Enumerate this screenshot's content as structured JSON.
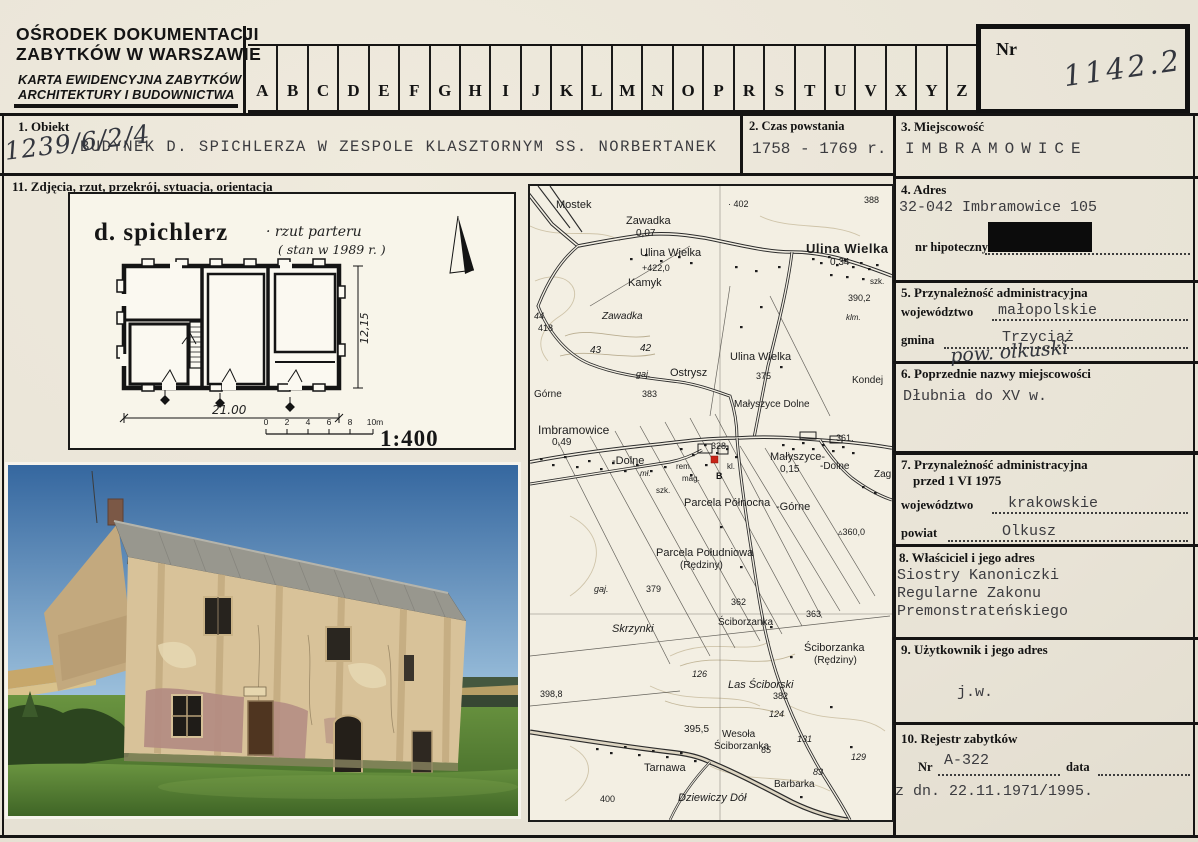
{
  "header": {
    "org_line1": "OŚRODEK DOKUMENTACJI",
    "org_line2": "ZABYTKÓW W WARSZAWIE",
    "card_type_line1": "KARTA EWIDENCYJNA ZABYTKÓW",
    "card_type_line2": "ARCHITEKTURY I BUDOWNICTWA",
    "alphabet": [
      "A",
      "B",
      "C",
      "D",
      "E",
      "F",
      "G",
      "H",
      "I",
      "J",
      "K",
      "L",
      "M",
      "N",
      "O",
      "P",
      "R",
      "S",
      "T",
      "U",
      "V",
      "X",
      "Y",
      "Z"
    ],
    "nr_label": "Nr",
    "nr_value": "1142.2"
  },
  "fields": {
    "obiekt": {
      "label": "1. Obiekt",
      "value": "BUDYNEK D. SPICHLERZA W ZESPOLE KLASZTORNYM SS. NORBERTANEK",
      "annotation": "1239/6/2/4"
    },
    "czas": {
      "label": "2. Czas powstania",
      "value": "1758 - 1769 r."
    },
    "miejscowosc": {
      "label": "3. Miejscowość",
      "value": "IMBRAMOWICE"
    },
    "adres": {
      "label": "4. Adres",
      "value": "32-042 Imbramowice 105",
      "hipoteczny_label": "nr hipoteczny"
    },
    "admin": {
      "label": "5. Przynależność administracyjna",
      "wojewodztwo_label": "województwo",
      "wojewodztwo": "małopolskie",
      "gmina_label": "gmina",
      "gmina": "Trzyciąż",
      "annotation": "pow. olkuski"
    },
    "poprzednie": {
      "label": "6. Poprzednie nazwy miejscowości",
      "value": "Dłubnia do XV w."
    },
    "admin1975": {
      "label_line1": "7. Przynależność administracyjna",
      "label_line2": "przed 1 VI 1975",
      "wojewodztwo_label": "województwo",
      "wojewodztwo": "krakowskie",
      "powiat_label": "powiat",
      "powiat": "Olkusz"
    },
    "wlasciciel": {
      "label": "8. Właściciel i jego adres",
      "line1": "Siostry Kanoniczki",
      "line2": "Regularne Zakonu",
      "line3": "Premonstrateńskiego"
    },
    "uzytkownik": {
      "label": "9. Użytkownik i jego adres",
      "value": "j.w."
    },
    "rejestr": {
      "label": "10. Rejestr zabytków",
      "nr_label": "Nr",
      "nr_value": "A-322",
      "data_label": "data",
      "data_value": "z dn. 22.11.1971/1995."
    },
    "zdjecia": {
      "label": "11. Zdjęcia, rzut, przekrój, sytuacja, orientacja"
    }
  },
  "drawing": {
    "title": "d. spichlerz",
    "subtitle1": "· rzut parteru",
    "subtitle2": "( stan w 1989 r. )",
    "dim_width": "21.00",
    "dim_height": "12,15",
    "scale": "1:400",
    "scale_ticks": [
      "0",
      "2",
      "4",
      "6",
      "8",
      "10m"
    ]
  },
  "map": {
    "marker": "B",
    "labels": [
      {
        "t": "Mostek",
        "x": 26,
        "y": 14,
        "s": 11
      },
      {
        "t": "Zawadka",
        "x": 96,
        "y": 30,
        "s": 11
      },
      {
        "t": "0,07",
        "x": 106,
        "y": 43,
        "s": 10
      },
      {
        "t": "· 402",
        "x": 198,
        "y": 14,
        "s": 9
      },
      {
        "t": "388",
        "x": 334,
        "y": 10,
        "s": 9
      },
      {
        "t": "Ulina Wielka",
        "x": 110,
        "y": 62,
        "s": 11
      },
      {
        "t": "+422,0",
        "x": 112,
        "y": 78,
        "s": 9
      },
      {
        "t": "Kamyk",
        "x": 98,
        "y": 92,
        "s": 11
      },
      {
        "t": "Ulina Wielka",
        "x": 276,
        "y": 56,
        "s": 13,
        "b": 1
      },
      {
        "t": "0,34",
        "x": 300,
        "y": 72,
        "s": 10
      },
      {
        "t": "szk.",
        "x": 340,
        "y": 92,
        "s": 8
      },
      {
        "t": "390,2",
        "x": 318,
        "y": 108,
        "s": 9
      },
      {
        "t": "klm.",
        "x": 316,
        "y": 128,
        "s": 8,
        "i": 1
      },
      {
        "t": "Zawadka",
        "x": 72,
        "y": 126,
        "s": 10,
        "i": 1
      },
      {
        "t": "44",
        "x": 4,
        "y": 126,
        "s": 9,
        "i": 1
      },
      {
        "t": "418",
        "x": 8,
        "y": 138,
        "s": 9
      },
      {
        "t": "43",
        "x": 60,
        "y": 160,
        "s": 10,
        "i": 1
      },
      {
        "t": "42",
        "x": 110,
        "y": 158,
        "s": 10,
        "i": 1
      },
      {
        "t": "gaj.",
        "x": 106,
        "y": 184,
        "s": 9,
        "i": 1
      },
      {
        "t": "Ostrysz",
        "x": 140,
        "y": 182,
        "s": 11
      },
      {
        "t": "383",
        "x": 112,
        "y": 204,
        "s": 9
      },
      {
        "t": "Górne",
        "x": 4,
        "y": 204,
        "s": 10
      },
      {
        "t": "Ulina Wielka",
        "x": 200,
        "y": 166,
        "s": 11
      },
      {
        "t": "375",
        "x": 226,
        "y": 186,
        "s": 9
      },
      {
        "t": "Kondej",
        "x": 322,
        "y": 190,
        "s": 10
      },
      {
        "t": "Małyszyce Dolne",
        "x": 204,
        "y": 214,
        "s": 10
      },
      {
        "t": "Imbramowice",
        "x": 8,
        "y": 238,
        "s": 12
      },
      {
        "t": "0,49",
        "x": 22,
        "y": 252,
        "s": 10
      },
      {
        "t": "328",
        "x": 181,
        "y": 256,
        "s": 9
      },
      {
        "t": "-Dolne",
        "x": 82,
        "y": 270,
        "s": 11
      },
      {
        "t": "mł.",
        "x": 110,
        "y": 284,
        "s": 8,
        "i": 1
      },
      {
        "t": "rem.",
        "x": 146,
        "y": 277,
        "s": 8
      },
      {
        "t": "mag.",
        "x": 152,
        "y": 289,
        "s": 8
      },
      {
        "t": "kl.",
        "x": 197,
        "y": 277,
        "s": 8
      },
      {
        "t": "szk.",
        "x": 126,
        "y": 301,
        "s": 8
      },
      {
        "t": "Małyszyce-",
        "x": 240,
        "y": 266,
        "s": 11
      },
      {
        "t": "0,15",
        "x": 250,
        "y": 279,
        "s": 10
      },
      {
        "t": "-Dolne",
        "x": 290,
        "y": 276,
        "s": 10
      },
      {
        "t": "Zag.",
        "x": 344,
        "y": 284,
        "s": 10
      },
      {
        "t": "361.",
        "x": 306,
        "y": 248,
        "s": 9
      },
      {
        "t": "Parcela Północna",
        "x": 154,
        "y": 312,
        "s": 11
      },
      {
        "t": "-Górne",
        "x": 246,
        "y": 316,
        "s": 11
      },
      {
        "t": "▵360,0",
        "x": 308,
        "y": 342,
        "s": 9
      },
      {
        "t": "Parcela Południowa",
        "x": 126,
        "y": 362,
        "s": 11
      },
      {
        "t": "(Rędziny)",
        "x": 150,
        "y": 375,
        "s": 10
      },
      {
        "t": "gaj.",
        "x": 64,
        "y": 399,
        "s": 9,
        "i": 1
      },
      {
        "t": "379",
        "x": 116,
        "y": 399,
        "s": 9
      },
      {
        "t": "362",
        "x": 201,
        "y": 412,
        "s": 9
      },
      {
        "t": "363",
        "x": 276,
        "y": 424,
        "s": 9
      },
      {
        "t": "Skrzynki",
        "x": 82,
        "y": 438,
        "s": 11,
        "i": 1
      },
      {
        "t": "Ściborzanka",
        "x": 188,
        "y": 432,
        "s": 10
      },
      {
        "t": "Ściborzanka",
        "x": 274,
        "y": 457,
        "s": 11
      },
      {
        "t": "(Rędziny)",
        "x": 284,
        "y": 470,
        "s": 10
      },
      {
        "t": "126",
        "x": 162,
        "y": 484,
        "s": 9,
        "i": 1
      },
      {
        "t": "Las Ściborski",
        "x": 198,
        "y": 494,
        "s": 11,
        "i": 1
      },
      {
        "t": "398,8",
        "x": 10,
        "y": 504,
        "s": 9
      },
      {
        "t": "382",
        "x": 243,
        "y": 506,
        "s": 9
      },
      {
        "t": "124",
        "x": 239,
        "y": 524,
        "s": 9,
        "i": 1
      },
      {
        "t": "395,5",
        "x": 154,
        "y": 539,
        "s": 10
      },
      {
        "t": "Wesoła",
        "x": 192,
        "y": 544,
        "s": 10
      },
      {
        "t": "Ściborzanka",
        "x": 184,
        "y": 556,
        "s": 10
      },
      {
        "t": "131",
        "x": 267,
        "y": 549,
        "s": 9,
        "i": 1
      },
      {
        "t": "65",
        "x": 231,
        "y": 560,
        "s": 9,
        "i": 1
      },
      {
        "t": "129",
        "x": 321,
        "y": 567,
        "s": 9,
        "i": 1
      },
      {
        "t": "83",
        "x": 283,
        "y": 582,
        "s": 9,
        "i": 1
      },
      {
        "t": "Tarnawa",
        "x": 114,
        "y": 577,
        "s": 11
      },
      {
        "t": "Barbarka",
        "x": 244,
        "y": 594,
        "s": 10
      },
      {
        "t": "Dziewiczy Dół",
        "x": 148,
        "y": 607,
        "s": 11,
        "i": 1
      },
      {
        "t": "400",
        "x": 70,
        "y": 609,
        "s": 9
      }
    ]
  },
  "colors": {
    "paper": "#e8e3d6",
    "line": "#151413",
    "typed": "#3b3b3f",
    "marker_red": "#c92418",
    "sky": "#3d6fae",
    "grass": "#55832f",
    "roof": "#9b9b93",
    "wall": "#d9c49b"
  }
}
